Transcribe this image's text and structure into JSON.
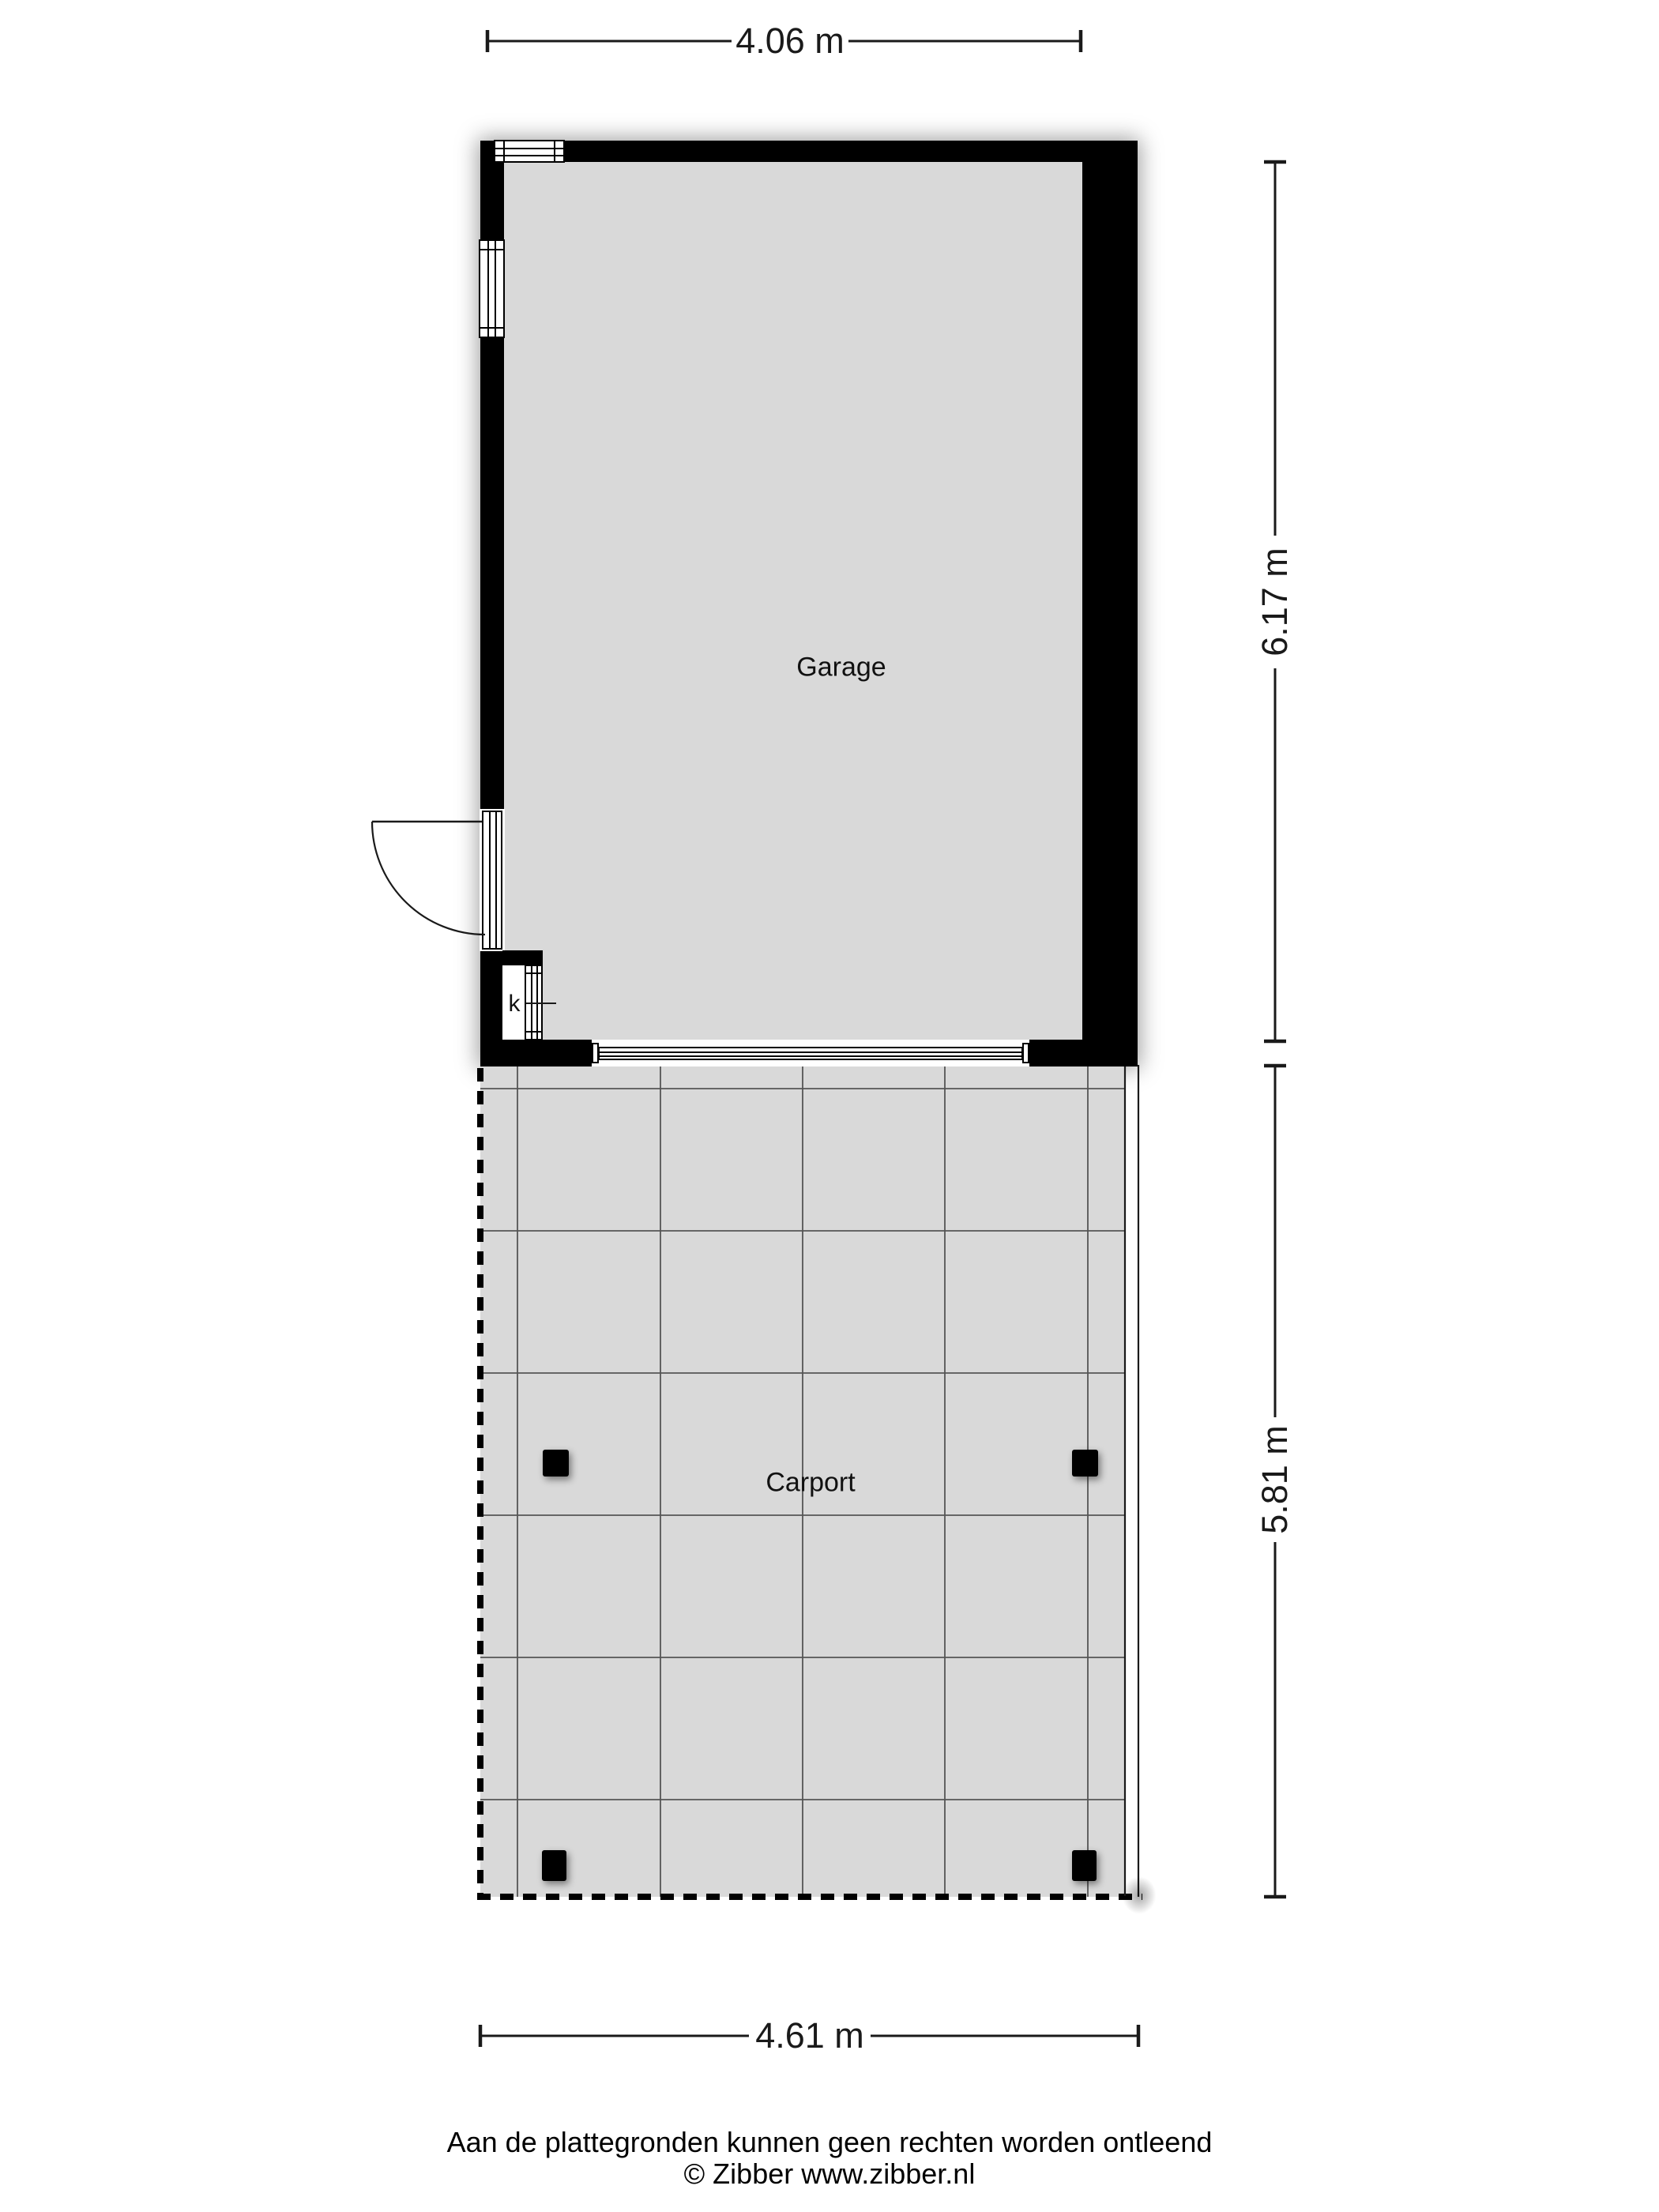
{
  "rooms": {
    "garage_label": "Garage",
    "carport_label": "Carport",
    "closet_label": "k"
  },
  "dimensions": {
    "garage_width": "4.06 m",
    "garage_depth": "6.17 m",
    "carport_depth": "5.81 m",
    "carport_width": "4.61 m"
  },
  "footer": {
    "disclaimer": "Aan de plattegronden kunnen geen rechten worden ontleend",
    "credit": "© Zibber www.zibber.nl"
  },
  "colors": {
    "wall": "#000000",
    "room_fill": "#d9d9d9",
    "grid_line": "#555555",
    "line": "#1a1a1a"
  }
}
